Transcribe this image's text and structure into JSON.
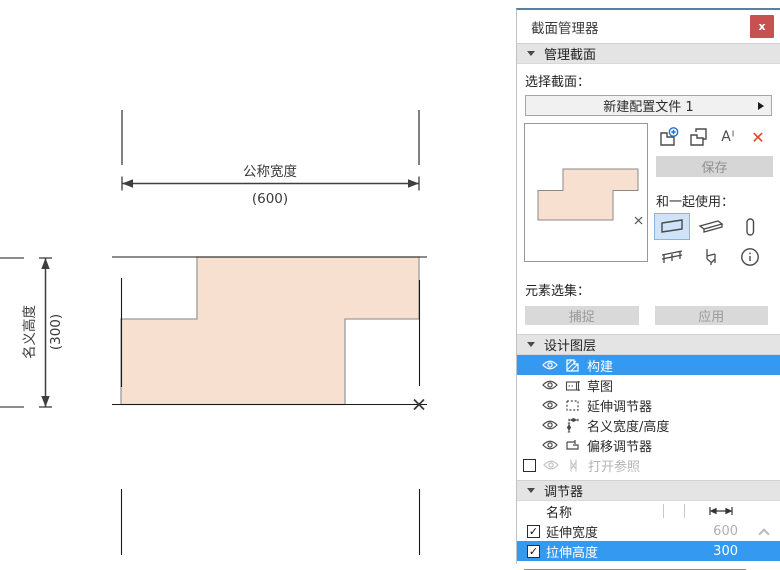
{
  "window": {
    "title": "截面管理器",
    "close_glyph": "x"
  },
  "manage": {
    "header": "管理截面",
    "select_label": "选择截面：",
    "profile_name": "新建配置文件 1",
    "save_label": "保存",
    "use_with_label": "和一起使用：",
    "rename_glyph": "Aᴵ",
    "delete_glyph": "✕"
  },
  "selection": {
    "label": "元素选集：",
    "capture_label": "捕捉",
    "apply_label": "应用"
  },
  "design_layers": {
    "header": "设计图层",
    "items": [
      {
        "label": "构建",
        "selected": true
      },
      {
        "label": "草图",
        "selected": false
      },
      {
        "label": "延伸调节器",
        "selected": false
      },
      {
        "label": "名义宽度/高度",
        "selected": false
      },
      {
        "label": "偏移调节器",
        "selected": false
      },
      {
        "label": "打开参照",
        "selected": false,
        "disabled": true,
        "checked": false
      }
    ]
  },
  "modifiers": {
    "header": "调节器",
    "name_col": "名称",
    "rows": [
      {
        "checked": true,
        "label": "延伸宽度",
        "value": "600",
        "selected": false
      },
      {
        "checked": true,
        "label": "拉伸高度",
        "value": "300",
        "selected": true
      }
    ]
  },
  "drawing": {
    "width_dim_label": "公称宽度",
    "width_dim_value": "(600)",
    "height_dim_label": "名义高度",
    "height_dim_value": "(300)"
  },
  "icons": {
    "names": [
      "close-icon",
      "new-profile-icon",
      "duplicate-profile-icon",
      "rename-icon",
      "delete-icon",
      "wall-icon",
      "beam-icon",
      "column-icon",
      "railing-icon",
      "object-icon",
      "info-icon",
      "eye-icon",
      "construction-layer-icon",
      "sketch-layer-icon",
      "stretch-modifier-icon",
      "nominal-size-icon",
      "offset-modifier-icon",
      "reference-icon",
      "dimension-column-icon",
      "origin-marker-icon"
    ]
  },
  "colors": {
    "selection_blue": "#3499f0",
    "close_red": "#c75050",
    "delete_red": "#e8421f",
    "profile_fill": "#f8e0d1",
    "wall_cell_bg": "#cfe4f8"
  }
}
